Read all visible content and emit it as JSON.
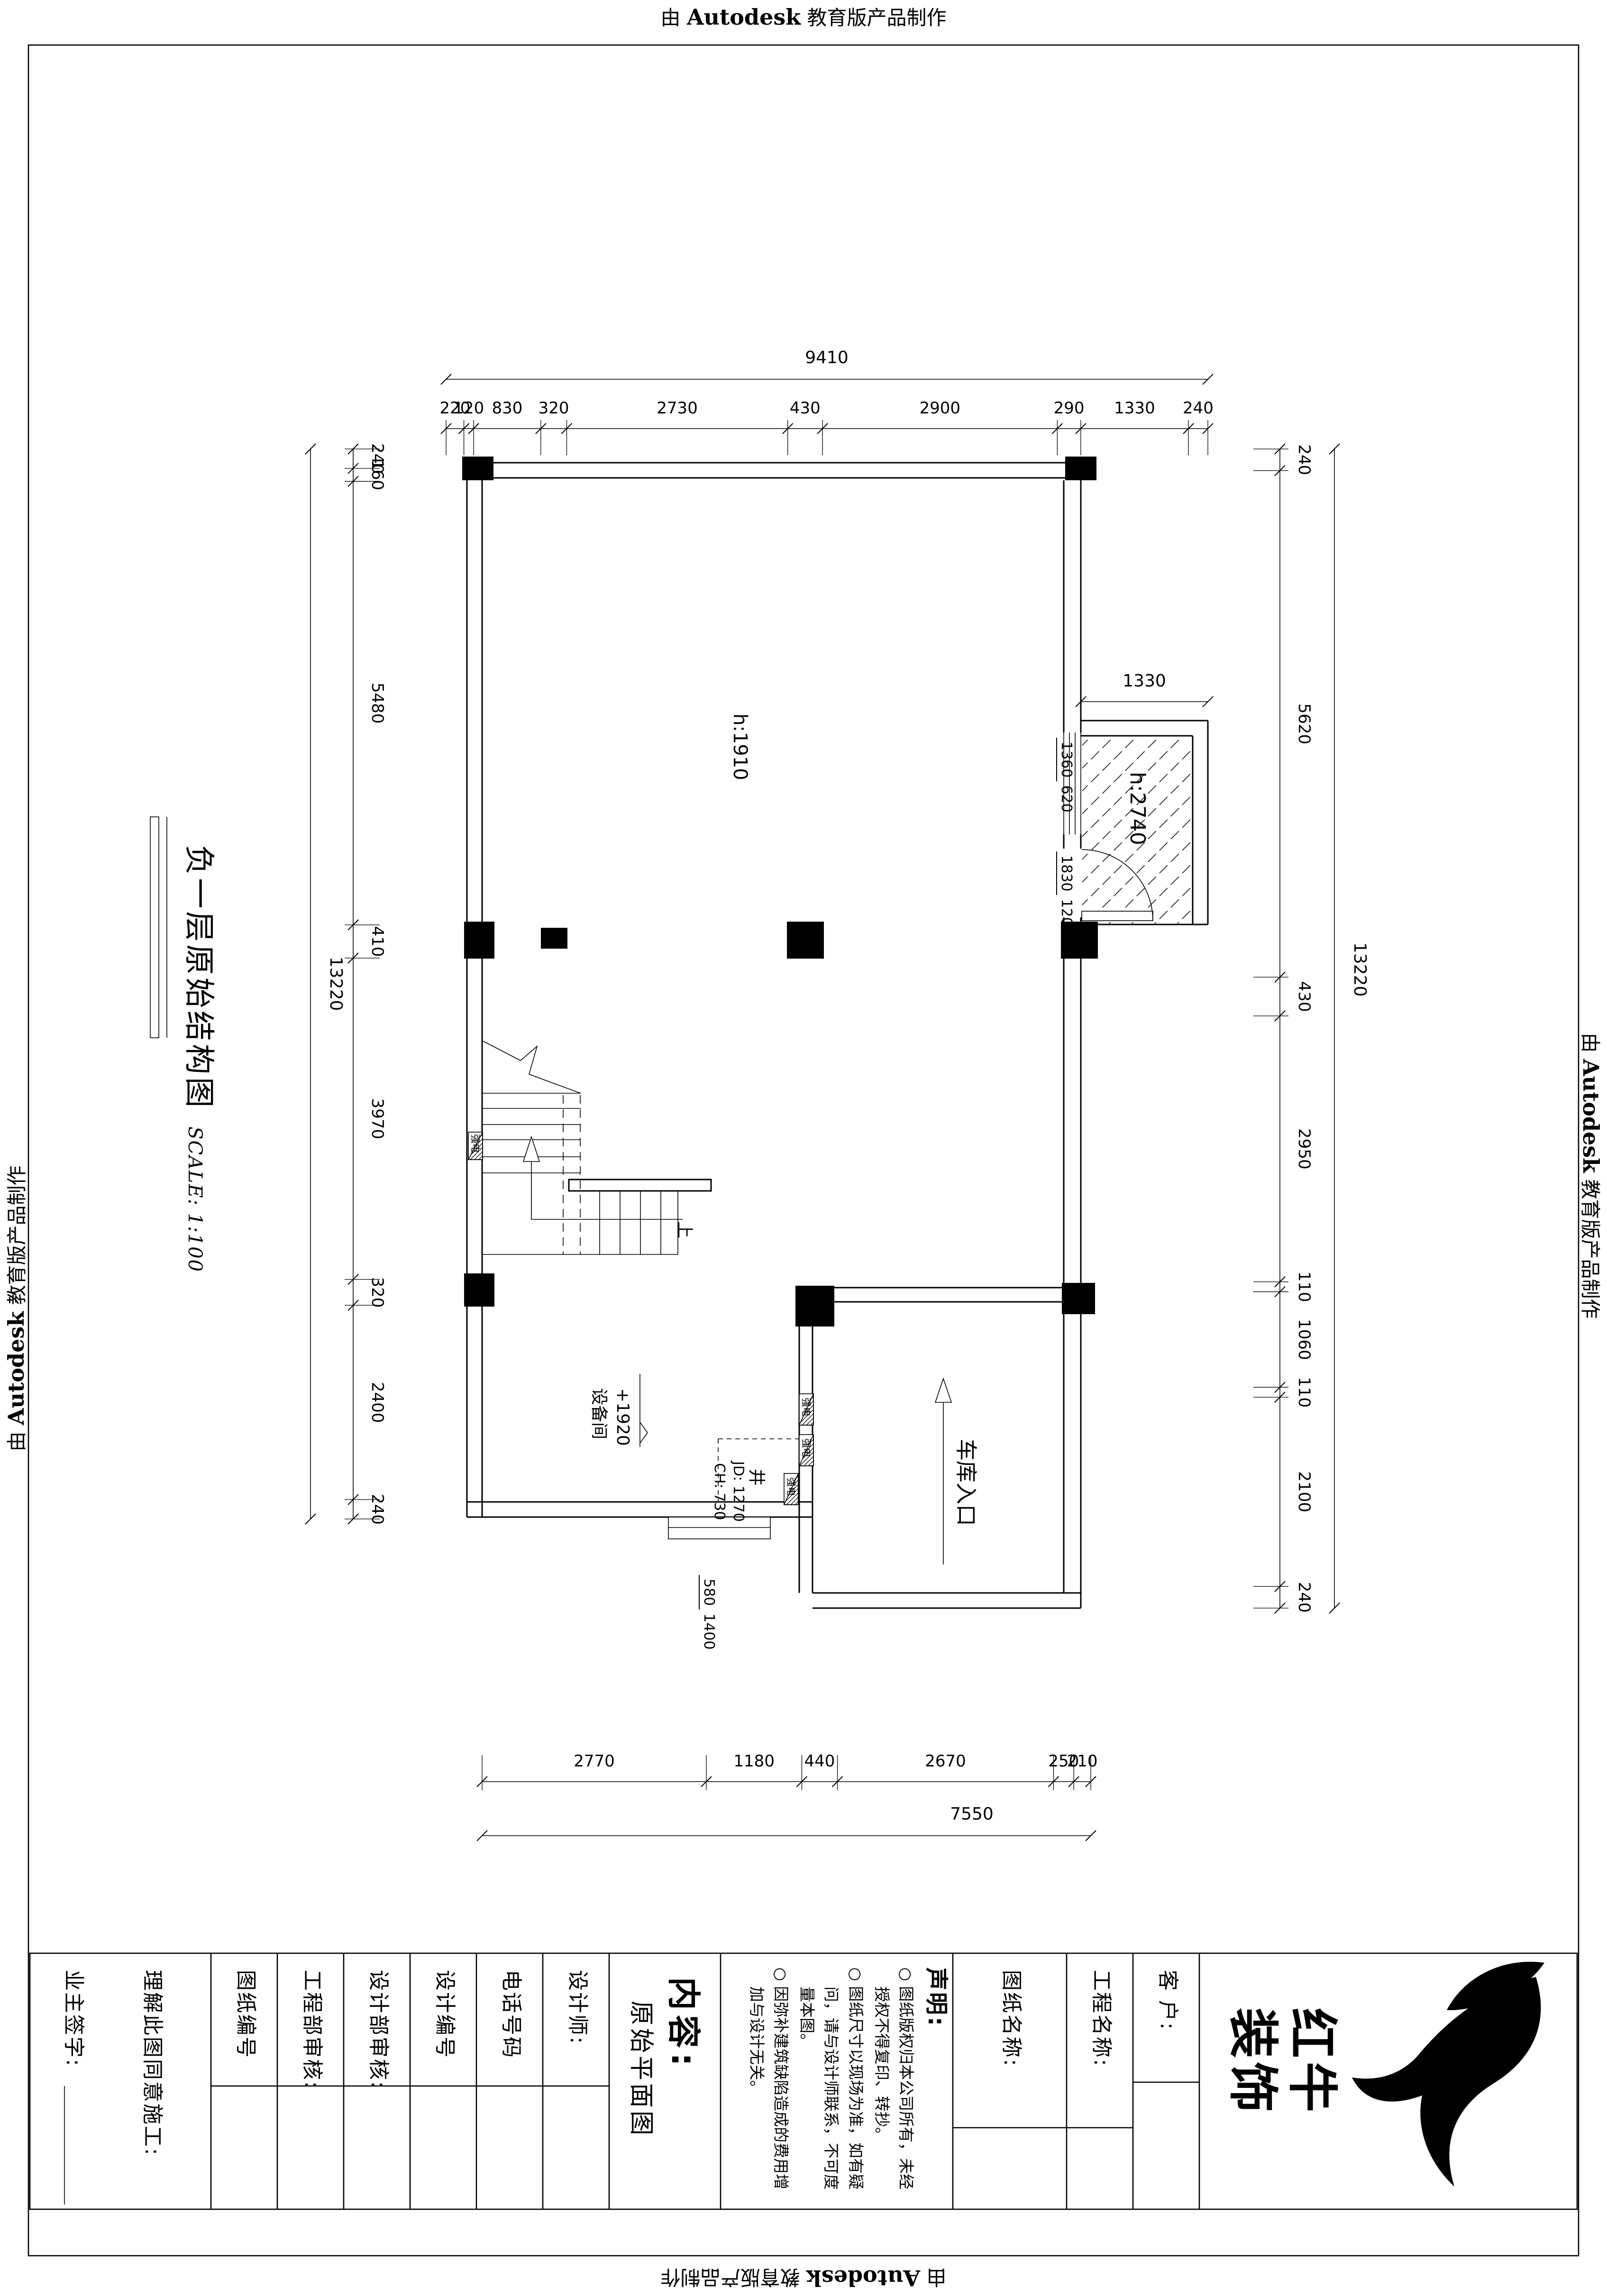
{
  "stamp": {
    "prefix": "由 ",
    "brand": "Autodesk",
    "suffix": " 教育版产品制作"
  },
  "drawing_title": {
    "text": "负一层原始结构图",
    "scale": "SCALE: 1:100"
  },
  "plan_labels": {
    "hall_height": "h:1910",
    "elevator_height": "h:2740",
    "stairs_up": "上",
    "equipment_room": "设备间",
    "equipment_elevation": "+1920",
    "shaft": "井",
    "shaft_jd": "JD: 1270",
    "shaft_ch": "CH: 730",
    "garage_entrance": "车库入口",
    "strong_power": "强电"
  },
  "dims": {
    "top_overall": "9410",
    "top": [
      "220",
      "120",
      "830",
      "320",
      "2730",
      "430",
      "2900",
      "290",
      "1330",
      "240"
    ],
    "left_overall": "13220",
    "left": [
      "240",
      "160",
      "5480",
      "410",
      "3970",
      "320",
      "2400",
      "240"
    ],
    "right_overall": "13220",
    "right": [
      "240",
      "5620",
      "430",
      "2950",
      "110",
      "1060",
      "110",
      "2100",
      "240"
    ],
    "bottom_overall": "7550",
    "bottom": [
      "2770",
      "1180",
      "440",
      "2670",
      "250",
      "210"
    ],
    "elevator_width": "1330",
    "window_upper": {
      "a": "1360",
      "b": "620"
    },
    "door_lower": {
      "a": "1830",
      "b": "120"
    },
    "step": {
      "a": "580",
      "b": "1400"
    }
  },
  "titleblock": {
    "owner_sign": "业主签字:",
    "agree": "理解此图同意施工:",
    "drawing_no": "图纸编号",
    "eng_review": "工程部审核:",
    "design_review": "设计部审核:",
    "design_no": "设计编号",
    "phone": "电话号码",
    "designer": "设计师:",
    "content_label": "内容:",
    "content_value": "原始平面图",
    "statement_title": "声明:",
    "statement_items": [
      "图纸版权归本公司所有，未经授权不得复印、转抄。",
      "图纸尺寸以现场为准，如有疑问，请与设计师联系，不可度量本图。",
      "因弥补建筑缺陷造成的费用增加与设计无关。"
    ],
    "drawing_name": "图纸名称:",
    "project_name": "工程名称:",
    "client": "客 户:",
    "brand": "红牛装饰"
  },
  "colors": {
    "ink": "#000000",
    "paper": "#ffffff"
  }
}
